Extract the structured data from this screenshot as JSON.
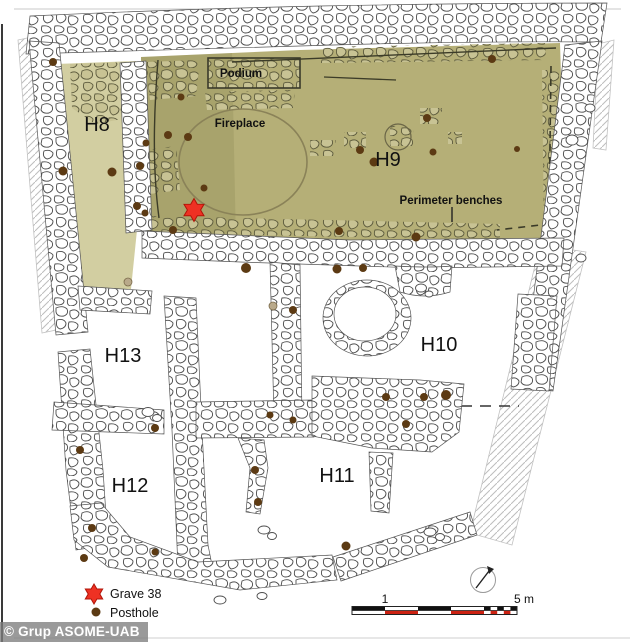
{
  "watermark": {
    "text": "© Grup ASOME-UAB"
  },
  "rooms": [
    {
      "id": "H8",
      "label": "H8"
    },
    {
      "id": "H9",
      "label": "H9"
    },
    {
      "id": "H10",
      "label": "H10"
    },
    {
      "id": "H11",
      "label": "H11"
    },
    {
      "id": "H12",
      "label": "H12"
    },
    {
      "id": "H13",
      "label": "H13"
    }
  ],
  "features": [
    {
      "label": "Podium"
    },
    {
      "label": "Fireplace"
    },
    {
      "label": "Perimeter benches"
    }
  ],
  "legend": {
    "grave": {
      "symbol": "red-star",
      "label": "Grave 38"
    },
    "posthole": {
      "symbol": "brown-dot",
      "label": "Posthole"
    }
  },
  "scale_bar": {
    "tick_label": "1",
    "end_label": "5 m",
    "length_m": 5
  },
  "markers": {
    "grave_38": {
      "x": 194,
      "y": 210,
      "radius": 11.5
    },
    "postholes": [
      [
        53,
        62,
        4
      ],
      [
        63,
        171,
        4.5
      ],
      [
        112,
        172,
        4.5
      ],
      [
        140,
        166,
        4
      ],
      [
        146,
        143,
        3.5
      ],
      [
        168,
        135,
        4
      ],
      [
        188,
        137,
        4
      ],
      [
        181,
        97,
        3.5
      ],
      [
        204,
        188,
        3.5
      ],
      [
        137,
        206,
        4
      ],
      [
        145,
        213,
        3.5
      ],
      [
        173,
        230,
        4
      ],
      [
        246,
        268,
        5
      ],
      [
        339,
        231,
        4
      ],
      [
        416,
        237,
        4.5
      ],
      [
        337,
        269,
        4.5
      ],
      [
        363,
        268,
        4
      ],
      [
        360,
        150,
        4
      ],
      [
        374,
        162,
        4.5
      ],
      [
        433,
        152,
        3.5
      ],
      [
        427,
        118,
        4
      ],
      [
        517,
        149,
        3
      ],
      [
        492,
        59,
        4
      ],
      [
        293,
        310,
        4
      ],
      [
        155,
        428,
        4
      ],
      [
        80,
        450,
        4
      ],
      [
        92,
        528,
        4
      ],
      [
        84,
        558,
        4
      ],
      [
        155,
        552,
        3.5
      ],
      [
        270,
        415,
        3.5
      ],
      [
        293,
        420,
        3.5
      ],
      [
        255,
        470,
        4
      ],
      [
        258,
        502,
        4
      ],
      [
        386,
        397,
        4
      ],
      [
        424,
        397,
        4
      ],
      [
        446,
        395,
        5
      ],
      [
        406,
        424,
        4
      ],
      [
        346,
        546,
        4.5
      ]
    ],
    "shallow_pits": [
      [
        128,
        282
      ],
      [
        273,
        306
      ]
    ]
  },
  "colors": {
    "floor_h9": "#b5af77",
    "floor_h8": "#d2cea1",
    "posthole": "#5c3a13",
    "grave": "#ee3123",
    "grave_outline": "#b01508",
    "scale_red": "#cc2212",
    "pit": "#b9a98a"
  }
}
